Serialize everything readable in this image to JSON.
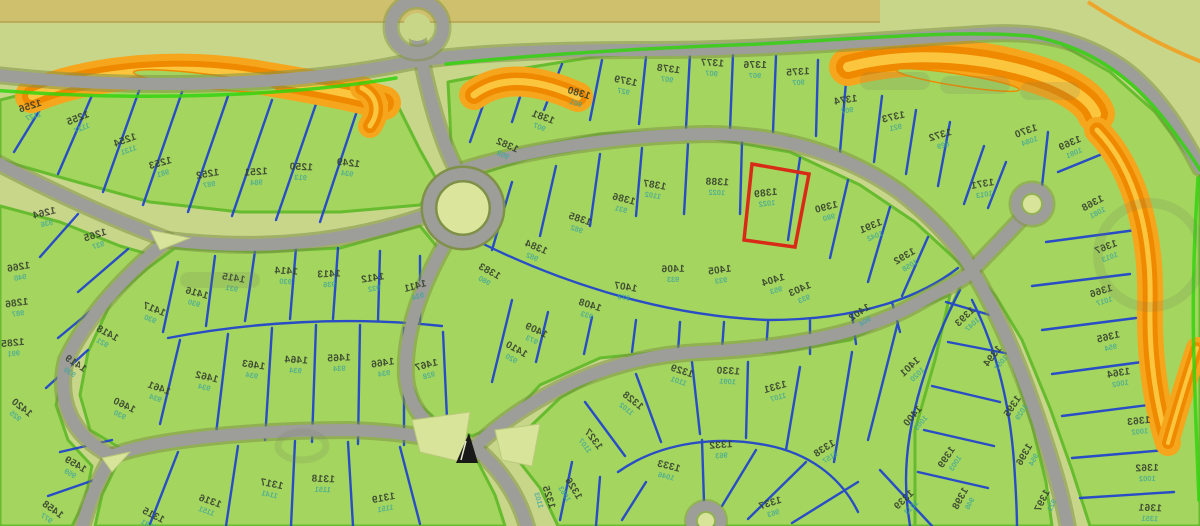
{
  "map": {
    "highlighted_lot": "1389",
    "colors": {
      "lot_fill": "#a4d55e",
      "ground": "#c8d68a",
      "top_strip": "#cfc06d",
      "road": "#9d9d99",
      "road_casing": "#7f9148",
      "boundary_blue": "#1d41cf",
      "block_green": "#66bb2e",
      "accent_green": "#34d30f",
      "water_orange": "#f6a61c",
      "water_orange_dark": "#ef8a00",
      "highlight_red": "#d92a18",
      "label": "#333d2e",
      "sublabel": "#3aa69e"
    },
    "lots": [
      {
        "n": "1249",
        "s": "934",
        "x": 348,
        "y": 166,
        "r": 6
      },
      {
        "n": "1250",
        "s": "913",
        "x": 301,
        "y": 170,
        "r": 2
      },
      {
        "n": "1251",
        "s": "984",
        "x": 256,
        "y": 175,
        "r": -4
      },
      {
        "n": "1252",
        "s": "987",
        "x": 208,
        "y": 177,
        "r": -10
      },
      {
        "n": "1253",
        "s": "981",
        "x": 161,
        "y": 166,
        "r": -16
      },
      {
        "n": "1254",
        "s": "1131",
        "x": 126,
        "y": 143,
        "r": -20
      },
      {
        "n": "1255",
        "s": "1127",
        "x": 79,
        "y": 121,
        "r": -22
      },
      {
        "n": "1256",
        "s": "1127",
        "x": 31,
        "y": 109,
        "r": -18
      },
      {
        "n": "1264",
        "s": "936",
        "x": 45,
        "y": 216,
        "r": -14
      },
      {
        "n": "1265",
        "s": "937",
        "x": 96,
        "y": 238,
        "r": -18
      },
      {
        "n": "1266",
        "s": "940",
        "x": 19,
        "y": 270,
        "r": -10
      },
      {
        "n": "1286",
        "s": "987",
        "x": 17,
        "y": 306,
        "r": -8
      },
      {
        "n": "1285",
        "s": "991",
        "x": 13,
        "y": 346,
        "r": -6
      },
      {
        "n": "1411",
        "s": "934",
        "x": 416,
        "y": 289,
        "r": -16
      },
      {
        "n": "1412",
        "s": "932",
        "x": 373,
        "y": 281,
        "r": -9
      },
      {
        "n": "1413",
        "s": "936",
        "x": 329,
        "y": 277,
        "r": -3
      },
      {
        "n": "1414",
        "s": "930",
        "x": 286,
        "y": 274,
        "r": 3
      },
      {
        "n": "1415",
        "s": "931",
        "x": 233,
        "y": 281,
        "r": 9
      },
      {
        "n": "1416",
        "s": "930",
        "x": 196,
        "y": 296,
        "r": 15
      },
      {
        "n": "1417",
        "s": "930",
        "x": 153,
        "y": 312,
        "r": 21
      },
      {
        "n": "1418",
        "s": "921",
        "x": 106,
        "y": 336,
        "r": 28
      },
      {
        "n": "1419",
        "s": "930",
        "x": 74,
        "y": 366,
        "r": 33
      },
      {
        "n": "1420",
        "s": "925",
        "x": 20,
        "y": 410,
        "r": 38
      },
      {
        "n": "1458",
        "s": "977",
        "x": 51,
        "y": 512,
        "r": 35
      },
      {
        "n": "1459",
        "s": "959",
        "x": 74,
        "y": 467,
        "r": 30
      },
      {
        "n": "1460",
        "s": "930",
        "x": 123,
        "y": 408,
        "r": 25
      },
      {
        "n": "1461",
        "s": "934",
        "x": 158,
        "y": 391,
        "r": 19
      },
      {
        "n": "1462",
        "s": "934",
        "x": 206,
        "y": 380,
        "r": 13
      },
      {
        "n": "1463",
        "s": "934",
        "x": 253,
        "y": 368,
        "r": 8
      },
      {
        "n": "1464",
        "s": "934",
        "x": 296,
        "y": 363,
        "r": 3
      },
      {
        "n": "1465",
        "s": "934",
        "x": 339,
        "y": 361,
        "r": -3
      },
      {
        "n": "1466",
        "s": "934",
        "x": 383,
        "y": 366,
        "r": -9
      },
      {
        "n": "1467",
        "s": "928",
        "x": 427,
        "y": 368,
        "r": -15
      },
      {
        "n": "1315",
        "s": "1181",
        "x": 152,
        "y": 518,
        "r": 26
      },
      {
        "n": "1316",
        "s": "1151",
        "x": 209,
        "y": 504,
        "r": 19
      },
      {
        "n": "1317",
        "s": "1141",
        "x": 271,
        "y": 487,
        "r": 11
      },
      {
        "n": "1318",
        "s": "1151",
        "x": 323,
        "y": 482,
        "r": 2
      },
      {
        "n": "1319",
        "s": "1151",
        "x": 384,
        "y": 501,
        "r": -11
      },
      {
        "n": "1375",
        "s": "907",
        "x": 798,
        "y": 75,
        "r": -4
      },
      {
        "n": "1376",
        "s": "907",
        "x": 755,
        "y": 68,
        "r": 0
      },
      {
        "n": "1377",
        "s": "907",
        "x": 712,
        "y": 66,
        "r": 3
      },
      {
        "n": "1378",
        "s": "907",
        "x": 668,
        "y": 72,
        "r": 7
      },
      {
        "n": "1379",
        "s": "927",
        "x": 625,
        "y": 84,
        "r": 11
      },
      {
        "n": "1380",
        "s": "901",
        "x": 578,
        "y": 96,
        "r": 16
      },
      {
        "n": "1381",
        "s": "907",
        "x": 542,
        "y": 120,
        "r": 20
      },
      {
        "n": "1382",
        "s": "958",
        "x": 506,
        "y": 148,
        "r": 24
      },
      {
        "n": "1374",
        "s": "907",
        "x": 846,
        "y": 103,
        "r": -9
      },
      {
        "n": "1373",
        "s": "921",
        "x": 894,
        "y": 120,
        "r": -13
      },
      {
        "n": "1372",
        "s": "829",
        "x": 941,
        "y": 138,
        "r": -17
      },
      {
        "n": "1371",
        "s": "1013",
        "x": 983,
        "y": 187,
        "r": -10
      },
      {
        "n": "1370",
        "s": "1084",
        "x": 1027,
        "y": 134,
        "r": -20
      },
      {
        "n": "1369",
        "s": "1081",
        "x": 1071,
        "y": 146,
        "r": -24
      },
      {
        "n": "1368",
        "s": "1081",
        "x": 1094,
        "y": 206,
        "r": -28
      },
      {
        "n": "1367",
        "s": "1013",
        "x": 1107,
        "y": 250,
        "r": -22
      },
      {
        "n": "1366",
        "s": "1017",
        "x": 1102,
        "y": 294,
        "r": -18
      },
      {
        "n": "1365",
        "s": "954",
        "x": 1109,
        "y": 340,
        "r": -14
      },
      {
        "n": "1364",
        "s": "1002",
        "x": 1119,
        "y": 376,
        "r": -10
      },
      {
        "n": "1363",
        "s": "1002",
        "x": 1139,
        "y": 424,
        "r": -6
      },
      {
        "n": "1362",
        "s": "1002",
        "x": 1147,
        "y": 471,
        "r": -2
      },
      {
        "n": "1361",
        "s": "1351",
        "x": 1150,
        "y": 511,
        "r": 2
      },
      {
        "n": "1383",
        "s": "980",
        "x": 488,
        "y": 274,
        "r": 28
      },
      {
        "n": "1384",
        "s": "982",
        "x": 535,
        "y": 250,
        "r": 22
      },
      {
        "n": "1385",
        "s": "982",
        "x": 579,
        "y": 222,
        "r": 18
      },
      {
        "n": "1386",
        "s": "931",
        "x": 623,
        "y": 202,
        "r": 14
      },
      {
        "n": "1387",
        "s": "1102",
        "x": 654,
        "y": 188,
        "r": 9
      },
      {
        "n": "1388",
        "s": "1022",
        "x": 717,
        "y": 185,
        "r": 2
      },
      {
        "n": "1389",
        "s": "1022",
        "x": 766,
        "y": 196,
        "r": -7
      },
      {
        "n": "1390",
        "s": "980",
        "x": 827,
        "y": 210,
        "r": -15
      },
      {
        "n": "1391",
        "s": "1042",
        "x": 872,
        "y": 229,
        "r": -23
      },
      {
        "n": "1392",
        "s": "1058",
        "x": 906,
        "y": 259,
        "r": -31
      },
      {
        "n": "1393",
        "s": "1047",
        "x": 967,
        "y": 319,
        "r": -44
      },
      {
        "n": "1394",
        "s": "1057",
        "x": 995,
        "y": 358,
        "r": -52
      },
      {
        "n": "1395",
        "s": "1029",
        "x": 1015,
        "y": 408,
        "r": -57
      },
      {
        "n": "1396",
        "s": "954",
        "x": 1027,
        "y": 456,
        "r": -61
      },
      {
        "n": "1397",
        "s": "921",
        "x": 1045,
        "y": 502,
        "r": -64
      },
      {
        "n": "1398",
        "s": "946",
        "x": 963,
        "y": 500,
        "r": -62
      },
      {
        "n": "1399",
        "s": "1003",
        "x": 949,
        "y": 459,
        "r": -57
      },
      {
        "n": "1400",
        "s": "1003",
        "x": 915,
        "y": 418,
        "r": -50
      },
      {
        "n": "1401",
        "s": "1020",
        "x": 912,
        "y": 369,
        "r": -44
      },
      {
        "n": "1402",
        "s": "904",
        "x": 861,
        "y": 315,
        "r": -34
      },
      {
        "n": "1403",
        "s": "933",
        "x": 801,
        "y": 292,
        "r": -24
      },
      {
        "n": "1404",
        "s": "953",
        "x": 774,
        "y": 283,
        "r": -17
      },
      {
        "n": "1405",
        "s": "933",
        "x": 720,
        "y": 273,
        "r": -8
      },
      {
        "n": "1406",
        "s": "933",
        "x": 673,
        "y": 272,
        "r": -1
      },
      {
        "n": "1407",
        "s": "973",
        "x": 625,
        "y": 290,
        "r": 9
      },
      {
        "n": "1408",
        "s": "933",
        "x": 589,
        "y": 308,
        "r": 17
      },
      {
        "n": "1409",
        "s": "973",
        "x": 535,
        "y": 333,
        "r": 25
      },
      {
        "n": "1410",
        "s": "920",
        "x": 515,
        "y": 352,
        "r": 29
      },
      {
        "n": "1325",
        "s": "1103",
        "x": 546,
        "y": 498,
        "r": 72
      },
      {
        "n": "1326",
        "s": "1063",
        "x": 571,
        "y": 490,
        "r": 58
      },
      {
        "n": "1327",
        "s": "1107",
        "x": 591,
        "y": 441,
        "r": 52
      },
      {
        "n": "1328",
        "s": "1102",
        "x": 631,
        "y": 403,
        "r": 38
      },
      {
        "n": "1329",
        "s": "1101",
        "x": 681,
        "y": 374,
        "r": 18
      },
      {
        "n": "1330",
        "s": "1091",
        "x": 728,
        "y": 374,
        "r": 3
      },
      {
        "n": "1331",
        "s": "1107",
        "x": 776,
        "y": 390,
        "r": -16
      },
      {
        "n": "1332",
        "s": "963",
        "x": 721,
        "y": 448,
        "r": -4
      },
      {
        "n": "1333",
        "s": "1046",
        "x": 668,
        "y": 469,
        "r": 14
      },
      {
        "n": "1337",
        "s": "963",
        "x": 771,
        "y": 506,
        "r": -18
      },
      {
        "n": "1338",
        "s": "1157",
        "x": 826,
        "y": 451,
        "r": -33
      },
      {
        "n": "1339",
        "s": "1013",
        "x": 906,
        "y": 502,
        "r": -44
      }
    ]
  }
}
